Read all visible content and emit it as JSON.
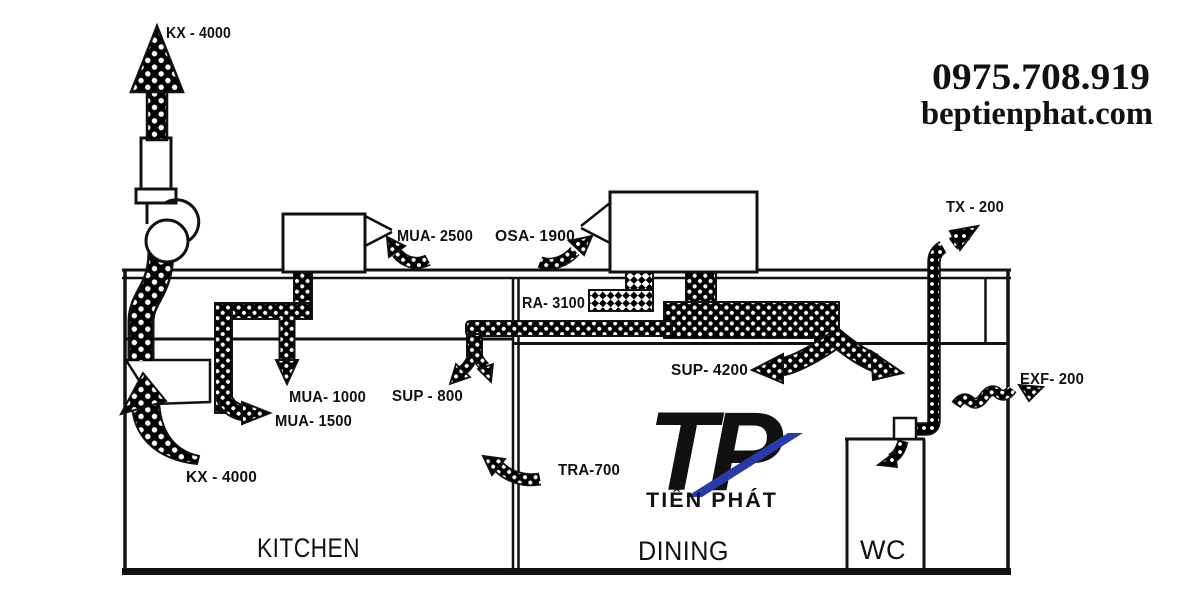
{
  "branding": {
    "phone": "0975.708.919",
    "website": "beptienphat.com",
    "logo": {
      "monogram": "TP",
      "name": "TIẾN PHÁT"
    }
  },
  "rooms": {
    "kitchen": "KITCHEN",
    "dining": "DINING",
    "wc": "WC"
  },
  "airflows": {
    "kx_stack": "KX - 4000",
    "mua_2500": "MUA- 2500",
    "osa_1900": "OSA- 1900",
    "ra_3100": "RA- 3100",
    "tx_200": "TX - 200",
    "mua_1000": "MUA- 1000",
    "sup_800": "SUP - 800",
    "sup_4200": "SUP- 4200",
    "mua_1500": "MUA- 1500",
    "exf_200": "EXF- 200",
    "tra_700": "TRA-700",
    "kx_hood": "KX - 4000"
  },
  "colors": {
    "header_blue": "#1551e6",
    "logo_navy": "#2a3aa6",
    "ink": "#111111"
  }
}
